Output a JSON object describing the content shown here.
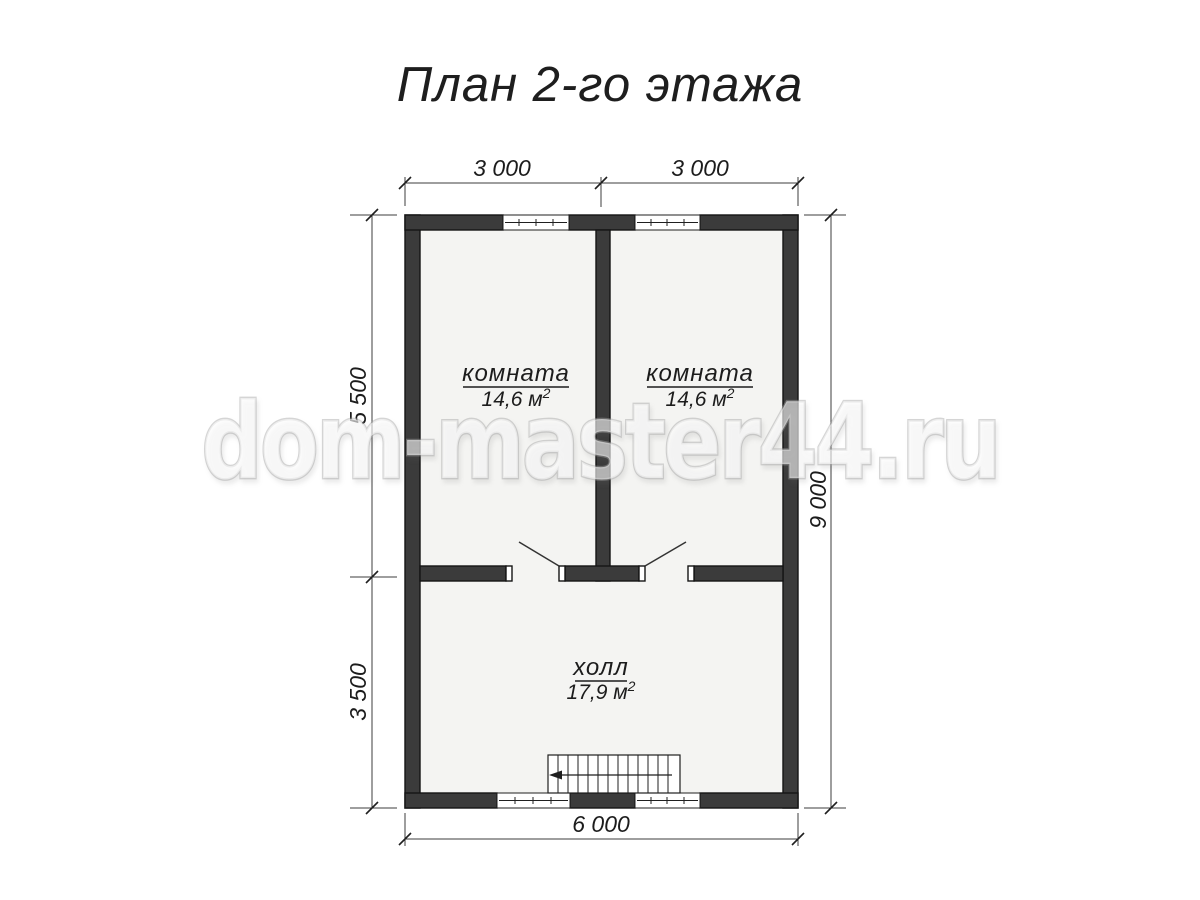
{
  "title": "План 2-го этажа",
  "watermark": "dom-master44.ru",
  "rooms": [
    {
      "name": "комната",
      "area": "14,6 м",
      "sup": "2"
    },
    {
      "name": "комната",
      "area": "14,6 м",
      "sup": "2"
    },
    {
      "name": "холл",
      "area": "17,9 м",
      "sup": "2"
    }
  ],
  "dimensions": {
    "top": [
      "3 000",
      "3 000"
    ],
    "left": [
      "5 500",
      "3 500"
    ],
    "right": [
      "9 000"
    ],
    "bottom": [
      "6 000"
    ]
  },
  "colors": {
    "wall": "#3b3b3b",
    "wall_outline": "#151515",
    "floor": "#f4f4f2",
    "line": "#3c3c3c",
    "text": "#1c1c1c",
    "watermark_fill": "rgba(255,255,255,0.60)",
    "watermark_stroke": "rgba(165,165,165,0.45)"
  }
}
